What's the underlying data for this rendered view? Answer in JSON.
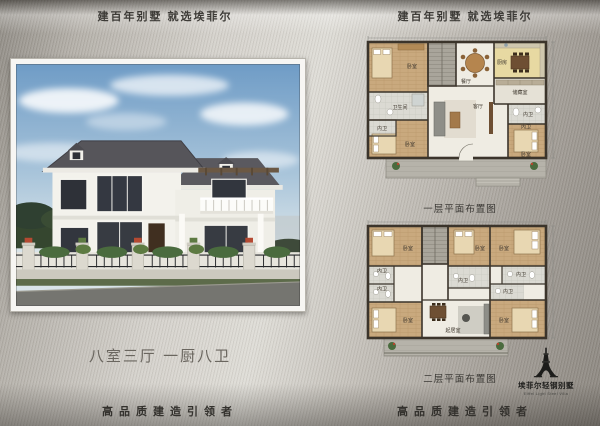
{
  "page": {
    "slogan_left": "建百年别墅  就选埃菲尔",
    "slogan_right": "建百年别墅  就选埃菲尔",
    "tagline": "八室三厅 一厨八卫",
    "footer_left": "高品质建造引领者",
    "footer_right": "高品质建造引领者"
  },
  "plans": {
    "floor1": {
      "caption": "一层平面布置图",
      "rooms": {
        "bedroom_tl": "卧室",
        "bath_left": "卫生间",
        "bath_bl": "内卫",
        "bedroom_bl": "卧室",
        "dining": "餐厅",
        "kitchen": "厨房",
        "storage": "储藏室",
        "bath_storage": "内卫",
        "living": "客厅",
        "bath_br": "内卫",
        "bedroom_br": "卧室"
      }
    },
    "floor2": {
      "caption": "二层平面布置图",
      "rooms": {
        "bedroom_tl": "卧室",
        "bath_tl": "内卫",
        "bath_bl": "内卫",
        "bedroom_bl": "卧室",
        "bedroom_tm": "卧室",
        "bath_tm": "内卫",
        "bedroom_tr": "卧室",
        "bath_tr": "内卫",
        "bath_br": "内卫",
        "bedroom_br": "卧室",
        "sitting": "起居室"
      }
    }
  },
  "logo": {
    "name": "埃菲尔轻钢别墅",
    "subtitle": "Eiffel Light Steel Villa",
    "icon": "eiffel-tower-icon"
  },
  "colors": {
    "metal_light": "#dedcd6",
    "metal_dark": "#8a857e",
    "text_dark": "#3d3b37",
    "plan_wall": "#3b342b",
    "plan_wood": "#c9a97e",
    "plan_tile": "#d9d8d2",
    "roof": "#56555a",
    "house_wall": "#f3f2ec",
    "sky": "#6f9cc6"
  }
}
